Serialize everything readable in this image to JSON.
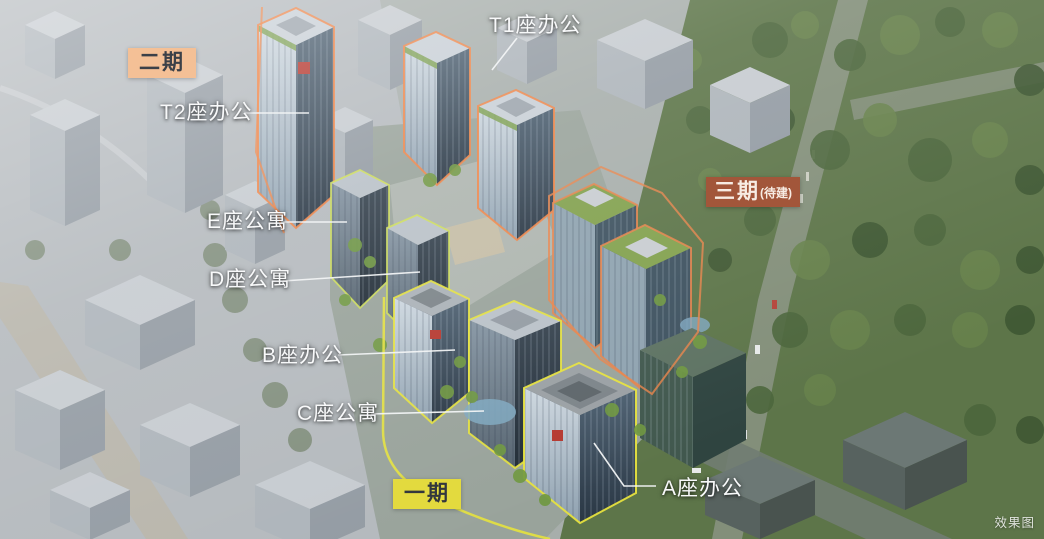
{
  "watermark": "效果图",
  "colors": {
    "label_text": "#f8f9fa",
    "phase1_badge_bg": "#e3da3e",
    "phase1_badge_text": "#33373d",
    "phase2_badge_bg": "#f4c096",
    "phase2_badge_text": "#3b4048",
    "phase3_badge_bg": "#a2563a",
    "phase3_badge_text": "#f7ece3",
    "outline_phase1": "#e6e23e",
    "outline_phase2": "#ef8446",
    "outline_phase3": "#e8834a",
    "leader_line": "#f2f4f5"
  },
  "phases": {
    "phase1": {
      "name": "一期"
    },
    "phase2": {
      "name": "二期"
    },
    "phase3": {
      "name": "三期",
      "status": "(待建)"
    }
  },
  "building_labels": {
    "t2": "T2座办公",
    "t1": "T1座办公",
    "e": "E座公寓",
    "d": "D座公寓",
    "b": "B座办公",
    "c": "C座公寓",
    "a": "A座办公"
  }
}
